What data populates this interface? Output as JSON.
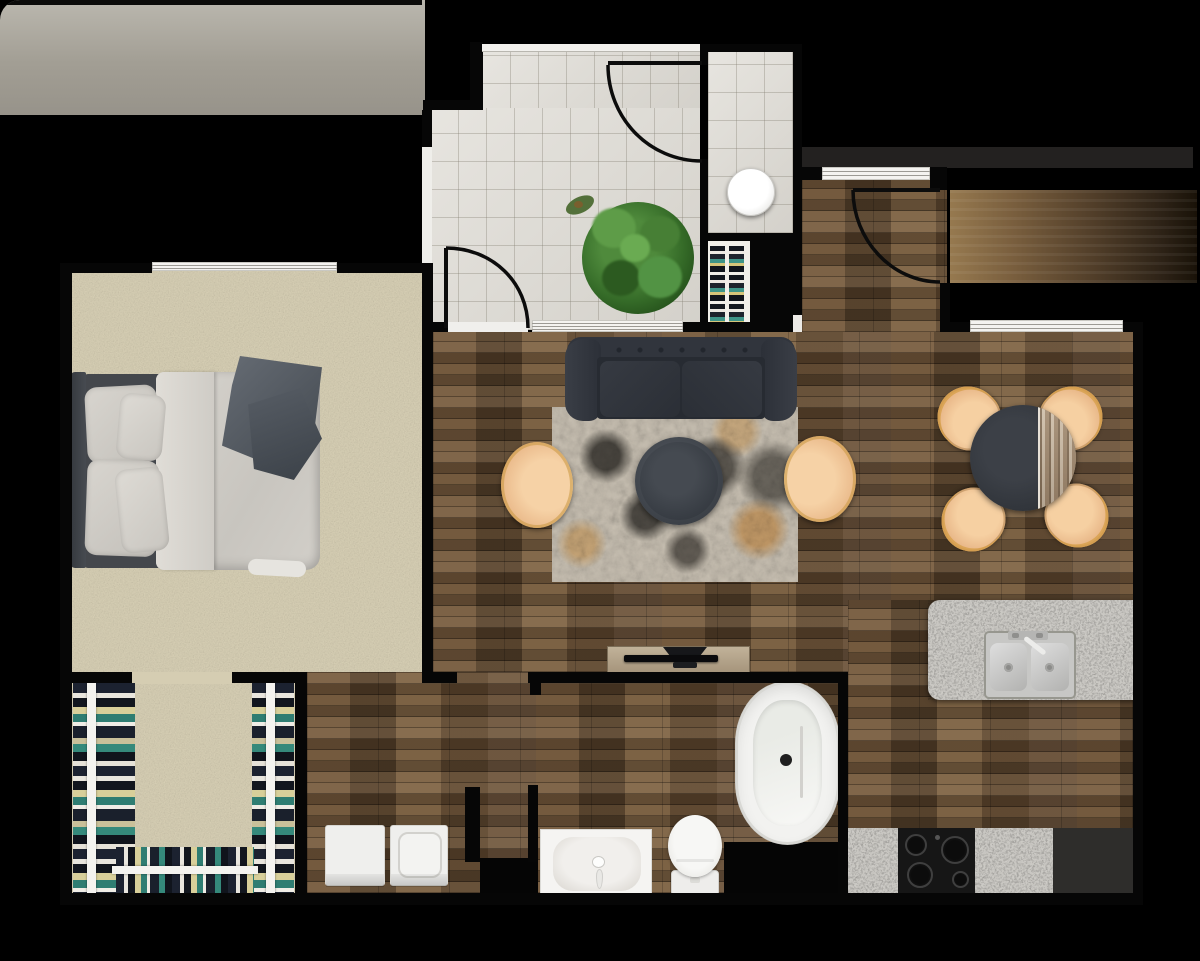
{
  "scene": {
    "type": "apartment floor plan",
    "view": "top-down 3D render",
    "canvas": {
      "width": 1200,
      "height": 961
    },
    "background_color": "#000000"
  },
  "rooms": [
    {
      "id": "balcony",
      "label": "balcony",
      "flooring": "concrete",
      "position": "top-left"
    },
    {
      "id": "bedroom",
      "label": "bedroom",
      "flooring": "carpet",
      "position": "left"
    },
    {
      "id": "closet",
      "label": "walk-in closet",
      "flooring": "carpet",
      "position": "bottom-left"
    },
    {
      "id": "entry",
      "label": "entry foyer",
      "flooring": "tile",
      "position": "top-center"
    },
    {
      "id": "entry-nook",
      "label": "entry nook",
      "flooring": "tile",
      "position": "top-center-right"
    },
    {
      "id": "hall",
      "label": "entry hall",
      "flooring": "hardwood",
      "position": "top-right"
    },
    {
      "id": "living",
      "label": "living room",
      "flooring": "hardwood",
      "position": "center"
    },
    {
      "id": "dining",
      "label": "dining area",
      "flooring": "hardwood",
      "position": "right"
    },
    {
      "id": "kitchen",
      "label": "kitchen",
      "flooring": "hardwood",
      "position": "bottom-right"
    },
    {
      "id": "bathroom",
      "label": "bathroom",
      "flooring": "hardwood",
      "position": "bottom-center"
    },
    {
      "id": "laundry",
      "label": "laundry nook",
      "flooring": "hardwood",
      "position": "bottom-center-left"
    }
  ],
  "furniture": [
    {
      "room": "bedroom",
      "items": [
        "queen bed with gray duvet",
        "four gray pillows",
        "dark gray throw blanket",
        "dark headboard"
      ]
    },
    {
      "room": "closet",
      "items": [
        "left clothes rail",
        "right clothes rail",
        "bottom clothes rail",
        "hanging clothes in navy, white, tan and teal"
      ]
    },
    {
      "room": "entry",
      "items": [
        "potted plant",
        "round white side table",
        "shoe shelf with two columns"
      ]
    },
    {
      "room": "living",
      "items": [
        "dark charcoal chesterfield sofa",
        "distressed beige-black-orange area rug",
        "round dark coffee table",
        "two tan barrel armchairs with gold frames",
        "light wood TV console",
        "flat-screen TV"
      ]
    },
    {
      "room": "dining",
      "items": [
        "round two-tone dining table",
        "four tan dining chairs with gold frames"
      ]
    },
    {
      "room": "kitchen",
      "items": [
        "granite island with stainless double sink and faucet",
        "granite counters",
        "black cooktop with four burners",
        "dark appliance section"
      ]
    },
    {
      "room": "bathroom",
      "items": [
        "freestanding oval tub",
        "toilet",
        "white vanity with basin and faucet"
      ]
    },
    {
      "room": "laundry",
      "items": [
        "dryer",
        "washer with round lid"
      ]
    }
  ],
  "openings": {
    "doors": [
      {
        "id": "nook-door",
        "location": "between entry foyer and entry nook",
        "style": "quarter-arc swing"
      },
      {
        "id": "entry-living-door",
        "location": "between entry foyer and living room",
        "style": "quarter-arc swing"
      },
      {
        "id": "main-door",
        "location": "entry hall to exterior corridor",
        "style": "quarter-arc swing"
      }
    ],
    "windows": [
      {
        "id": "bedroom-balcony-window",
        "wall": "bedroom north wall"
      },
      {
        "id": "hall-window",
        "wall": "entry hall north wall"
      },
      {
        "id": "dining-window",
        "wall": "dining north wall"
      },
      {
        "id": "living-partition-window",
        "wall": "entry south wall"
      }
    ]
  },
  "palette": {
    "background": "#000000",
    "walls": "#060606",
    "exterior_white_wall": "#efeeea",
    "carpet": "#d9d1b6",
    "tile": "#dfdcd5",
    "hardwood": "#5d4832",
    "balcony_concrete": "#aba79d",
    "granite": "#d2d0cb",
    "sofa": "#2f333b",
    "accent_chair_tan": "#ecbf92",
    "chair_gold_trim": "#c99740",
    "rug_base": "#c8c0b2",
    "rug_orange": "#bb7c2e",
    "plant_green": "#3f7a33",
    "clothes_teal": "#3e9487",
    "clothes_tan": "#d6c57a",
    "fixture_white": "#f2f2f0"
  }
}
